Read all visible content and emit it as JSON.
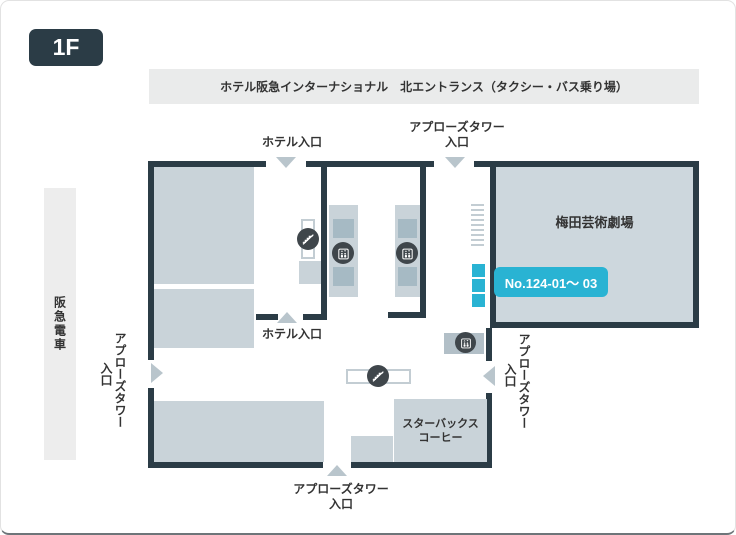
{
  "floor_badge": {
    "label": "1F"
  },
  "banner": {
    "text": "ホテル阪急インターナショナル　北エントランス（タクシー・バス乗り場）"
  },
  "rail": {
    "label": "阪急電車"
  },
  "entrances": {
    "hotel_top": "ホテル入口",
    "hotel_mid": "ホテル入口",
    "applause_top": {
      "line1": "アプローズタワー",
      "line2": "入口"
    },
    "applause_left": {
      "line1": "アプローズタワー",
      "line2": "入口"
    },
    "applause_right": {
      "line1": "アプローズタワー",
      "line2": "入口"
    },
    "applause_bottom": {
      "line1": "アプローズタワー",
      "line2": "入口"
    }
  },
  "theater": {
    "name": "梅田芸術劇場",
    "badge": "No.124-01～ 03"
  },
  "starbucks": {
    "line1": "スターバックス",
    "line2": "コーヒー"
  },
  "icons": {
    "escalator_icon": "escalator",
    "elevator_icon": "elevator",
    "entrance_arrow_icon": "triangle-arrow",
    "stairs_hatch": "stairs"
  },
  "colors": {
    "wall": "#2b3c46",
    "block": "#c9d3d9",
    "block_dark": "#a6bac4",
    "theater_fill": "#cdd7dd",
    "icon_circle": "#3f464b",
    "arrow": "#b9c5cc",
    "accent_cyan": "#29b3d3",
    "banner_bg": "#eaebeb",
    "rail_bg": "#ededed",
    "outline": "#c3cdd3",
    "text": "#333333"
  }
}
